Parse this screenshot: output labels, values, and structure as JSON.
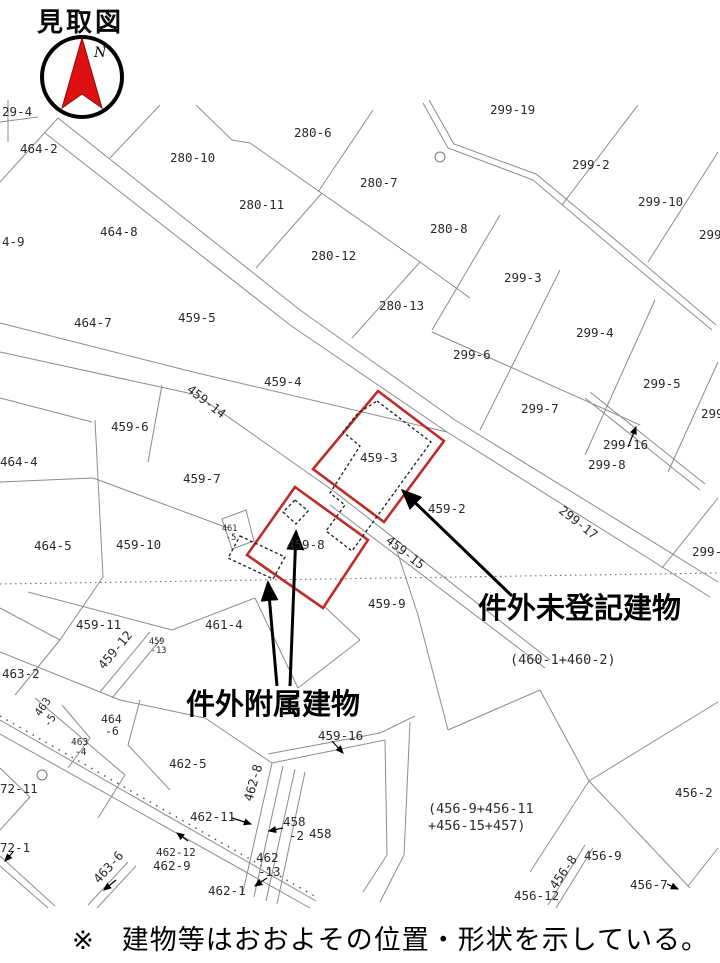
{
  "title": "見取図",
  "compass": {
    "label": "N"
  },
  "colors": {
    "red_parcel": "#bf2b2b",
    "needle_red": "#dc1010",
    "line_gray": "#8b8b8b"
  },
  "footer": {
    "marker": "※",
    "note": "建物等はおおよその位置・形状を示している。"
  },
  "annotations": {
    "unregistered_building": "件外未登記建物",
    "attached_building": "件外附属建物"
  },
  "highlighted_parcels": [
    "459-3",
    "459-8"
  ],
  "parcel_labels": [
    {
      "t": "299-19",
      "x": 490,
      "y": 114,
      "clip": true
    },
    {
      "t": "29-4",
      "x": 2,
      "y": 116
    },
    {
      "t": "464-2",
      "x": 20,
      "y": 153
    },
    {
      "t": "280-6",
      "x": 294,
      "y": 137
    },
    {
      "t": "280-10",
      "x": 170,
      "y": 162
    },
    {
      "t": "280-7",
      "x": 360,
      "y": 187
    },
    {
      "t": "299-2",
      "x": 572,
      "y": 169
    },
    {
      "t": "299-10",
      "x": 638,
      "y": 206
    },
    {
      "t": "280-11",
      "x": 239,
      "y": 209
    },
    {
      "t": "280-8",
      "x": 430,
      "y": 233
    },
    {
      "t": "464-8",
      "x": 100,
      "y": 236
    },
    {
      "t": "299",
      "x": 699,
      "y": 239
    },
    {
      "t": "4-9",
      "x": 2,
      "y": 246
    },
    {
      "t": "280-12",
      "x": 311,
      "y": 260
    },
    {
      "t": "299-3",
      "x": 504,
      "y": 282
    },
    {
      "t": "280-13",
      "x": 379,
      "y": 310
    },
    {
      "t": "459-5",
      "x": 178,
      "y": 322
    },
    {
      "t": "464-7",
      "x": 74,
      "y": 327
    },
    {
      "t": "299-4",
      "x": 576,
      "y": 337
    },
    {
      "t": "299-6",
      "x": 453,
      "y": 359
    },
    {
      "t": "459-4",
      "x": 264,
      "y": 386
    },
    {
      "t": "299-5",
      "x": 643,
      "y": 388
    },
    {
      "t": "459-14",
      "x": 186,
      "y": 391,
      "rot": 38
    },
    {
      "t": "299-7",
      "x": 521,
      "y": 413
    },
    {
      "t": "299",
      "x": 701,
      "y": 418
    },
    {
      "t": "459-6",
      "x": 111,
      "y": 431
    },
    {
      "t": "299-16",
      "x": 603,
      "y": 449
    },
    {
      "t": "464-4",
      "x": 0,
      "y": 466
    },
    {
      "t": "459-3",
      "x": 360,
      "y": 462
    },
    {
      "t": "459-7",
      "x": 183,
      "y": 483
    },
    {
      "t": "299-8",
      "x": 588,
      "y": 469
    },
    {
      "t": "459-2",
      "x": 428,
      "y": 513
    },
    {
      "t": "299-17",
      "x": 558,
      "y": 512,
      "rot": 38
    },
    {
      "t": "461",
      "x": 222,
      "y": 531,
      "size": 8.5
    },
    {
      "t": "-5",
      "x": 226,
      "y": 540,
      "size": 8.5
    },
    {
      "t": "459-10",
      "x": 116,
      "y": 549
    },
    {
      "t": "464-5",
      "x": 34,
      "y": 550
    },
    {
      "t": "459-8",
      "x": 287,
      "y": 549
    },
    {
      "t": "459-15",
      "x": 385,
      "y": 542,
      "rot": 38
    },
    {
      "t": "299-",
      "x": 692,
      "y": 556
    },
    {
      "t": "459-9",
      "x": 368,
      "y": 608
    },
    {
      "t": "459-11",
      "x": 76,
      "y": 629
    },
    {
      "t": "461-4",
      "x": 205,
      "y": 629
    },
    {
      "t": "459",
      "x": 149,
      "y": 644,
      "size": 8.5
    },
    {
      "t": "-13",
      "x": 151,
      "y": 653,
      "size": 8.5
    },
    {
      "t": "件外未登記建物",
      "x": 478,
      "y": 618,
      "size": 29,
      "bold": true
    },
    {
      "t": "459-12",
      "x": 104,
      "y": 670,
      "rot": -50
    },
    {
      "t": "463-2",
      "x": 2,
      "y": 678
    },
    {
      "t": "(460-1+460-2)",
      "x": 510,
      "y": 664,
      "size": 13.5
    },
    {
      "t": "件外附属建物",
      "x": 186,
      "y": 714,
      "size": 29,
      "bold": true
    },
    {
      "t": "463",
      "x": 40,
      "y": 717,
      "rot": -55,
      "size": 11
    },
    {
      "t": "-5",
      "x": 49,
      "y": 728,
      "rot": -55,
      "size": 11
    },
    {
      "t": "464",
      "x": 101,
      "y": 723,
      "size": 11.5
    },
    {
      "t": "-6",
      "x": 105,
      "y": 735,
      "size": 11.5
    },
    {
      "t": "459-16",
      "x": 318,
      "y": 740
    },
    {
      "t": "463",
      "x": 71,
      "y": 745,
      "size": 9.5
    },
    {
      "t": "-4",
      "x": 75,
      "y": 755,
      "size": 9.5
    },
    {
      "t": "462-5",
      "x": 169,
      "y": 768
    },
    {
      "t": "72-11",
      "x": 0,
      "y": 793
    },
    {
      "t": "462-8",
      "x": 252,
      "y": 802,
      "rot": -74
    },
    {
      "t": "456-2",
      "x": 675,
      "y": 797
    },
    {
      "t": "(456-9+456-11",
      "x": 428,
      "y": 813,
      "size": 13.5
    },
    {
      "t": "462-11",
      "x": 190,
      "y": 821
    },
    {
      "t": "+456-15+457)",
      "x": 428,
      "y": 830,
      "size": 13.5
    },
    {
      "t": "458",
      "x": 283,
      "y": 826
    },
    {
      "t": "458",
      "x": 309,
      "y": 838
    },
    {
      "t": "-2",
      "x": 289,
      "y": 840
    },
    {
      "t": "72-1",
      "x": 0,
      "y": 852
    },
    {
      "t": "462-12",
      "x": 156,
      "y": 856,
      "size": 11
    },
    {
      "t": "462",
      "x": 256,
      "y": 862
    },
    {
      "t": "462-9",
      "x": 153,
      "y": 870
    },
    {
      "t": "456-9",
      "x": 584,
      "y": 860
    },
    {
      "t": "-13",
      "x": 258,
      "y": 876
    },
    {
      "t": "463-6",
      "x": 99,
      "y": 884,
      "rot": -48
    },
    {
      "t": "456-8",
      "x": 556,
      "y": 890,
      "rot": -55
    },
    {
      "t": "456-7",
      "x": 630,
      "y": 889
    },
    {
      "t": "462-1",
      "x": 208,
      "y": 895
    },
    {
      "t": "456-12",
      "x": 514,
      "y": 900
    }
  ]
}
